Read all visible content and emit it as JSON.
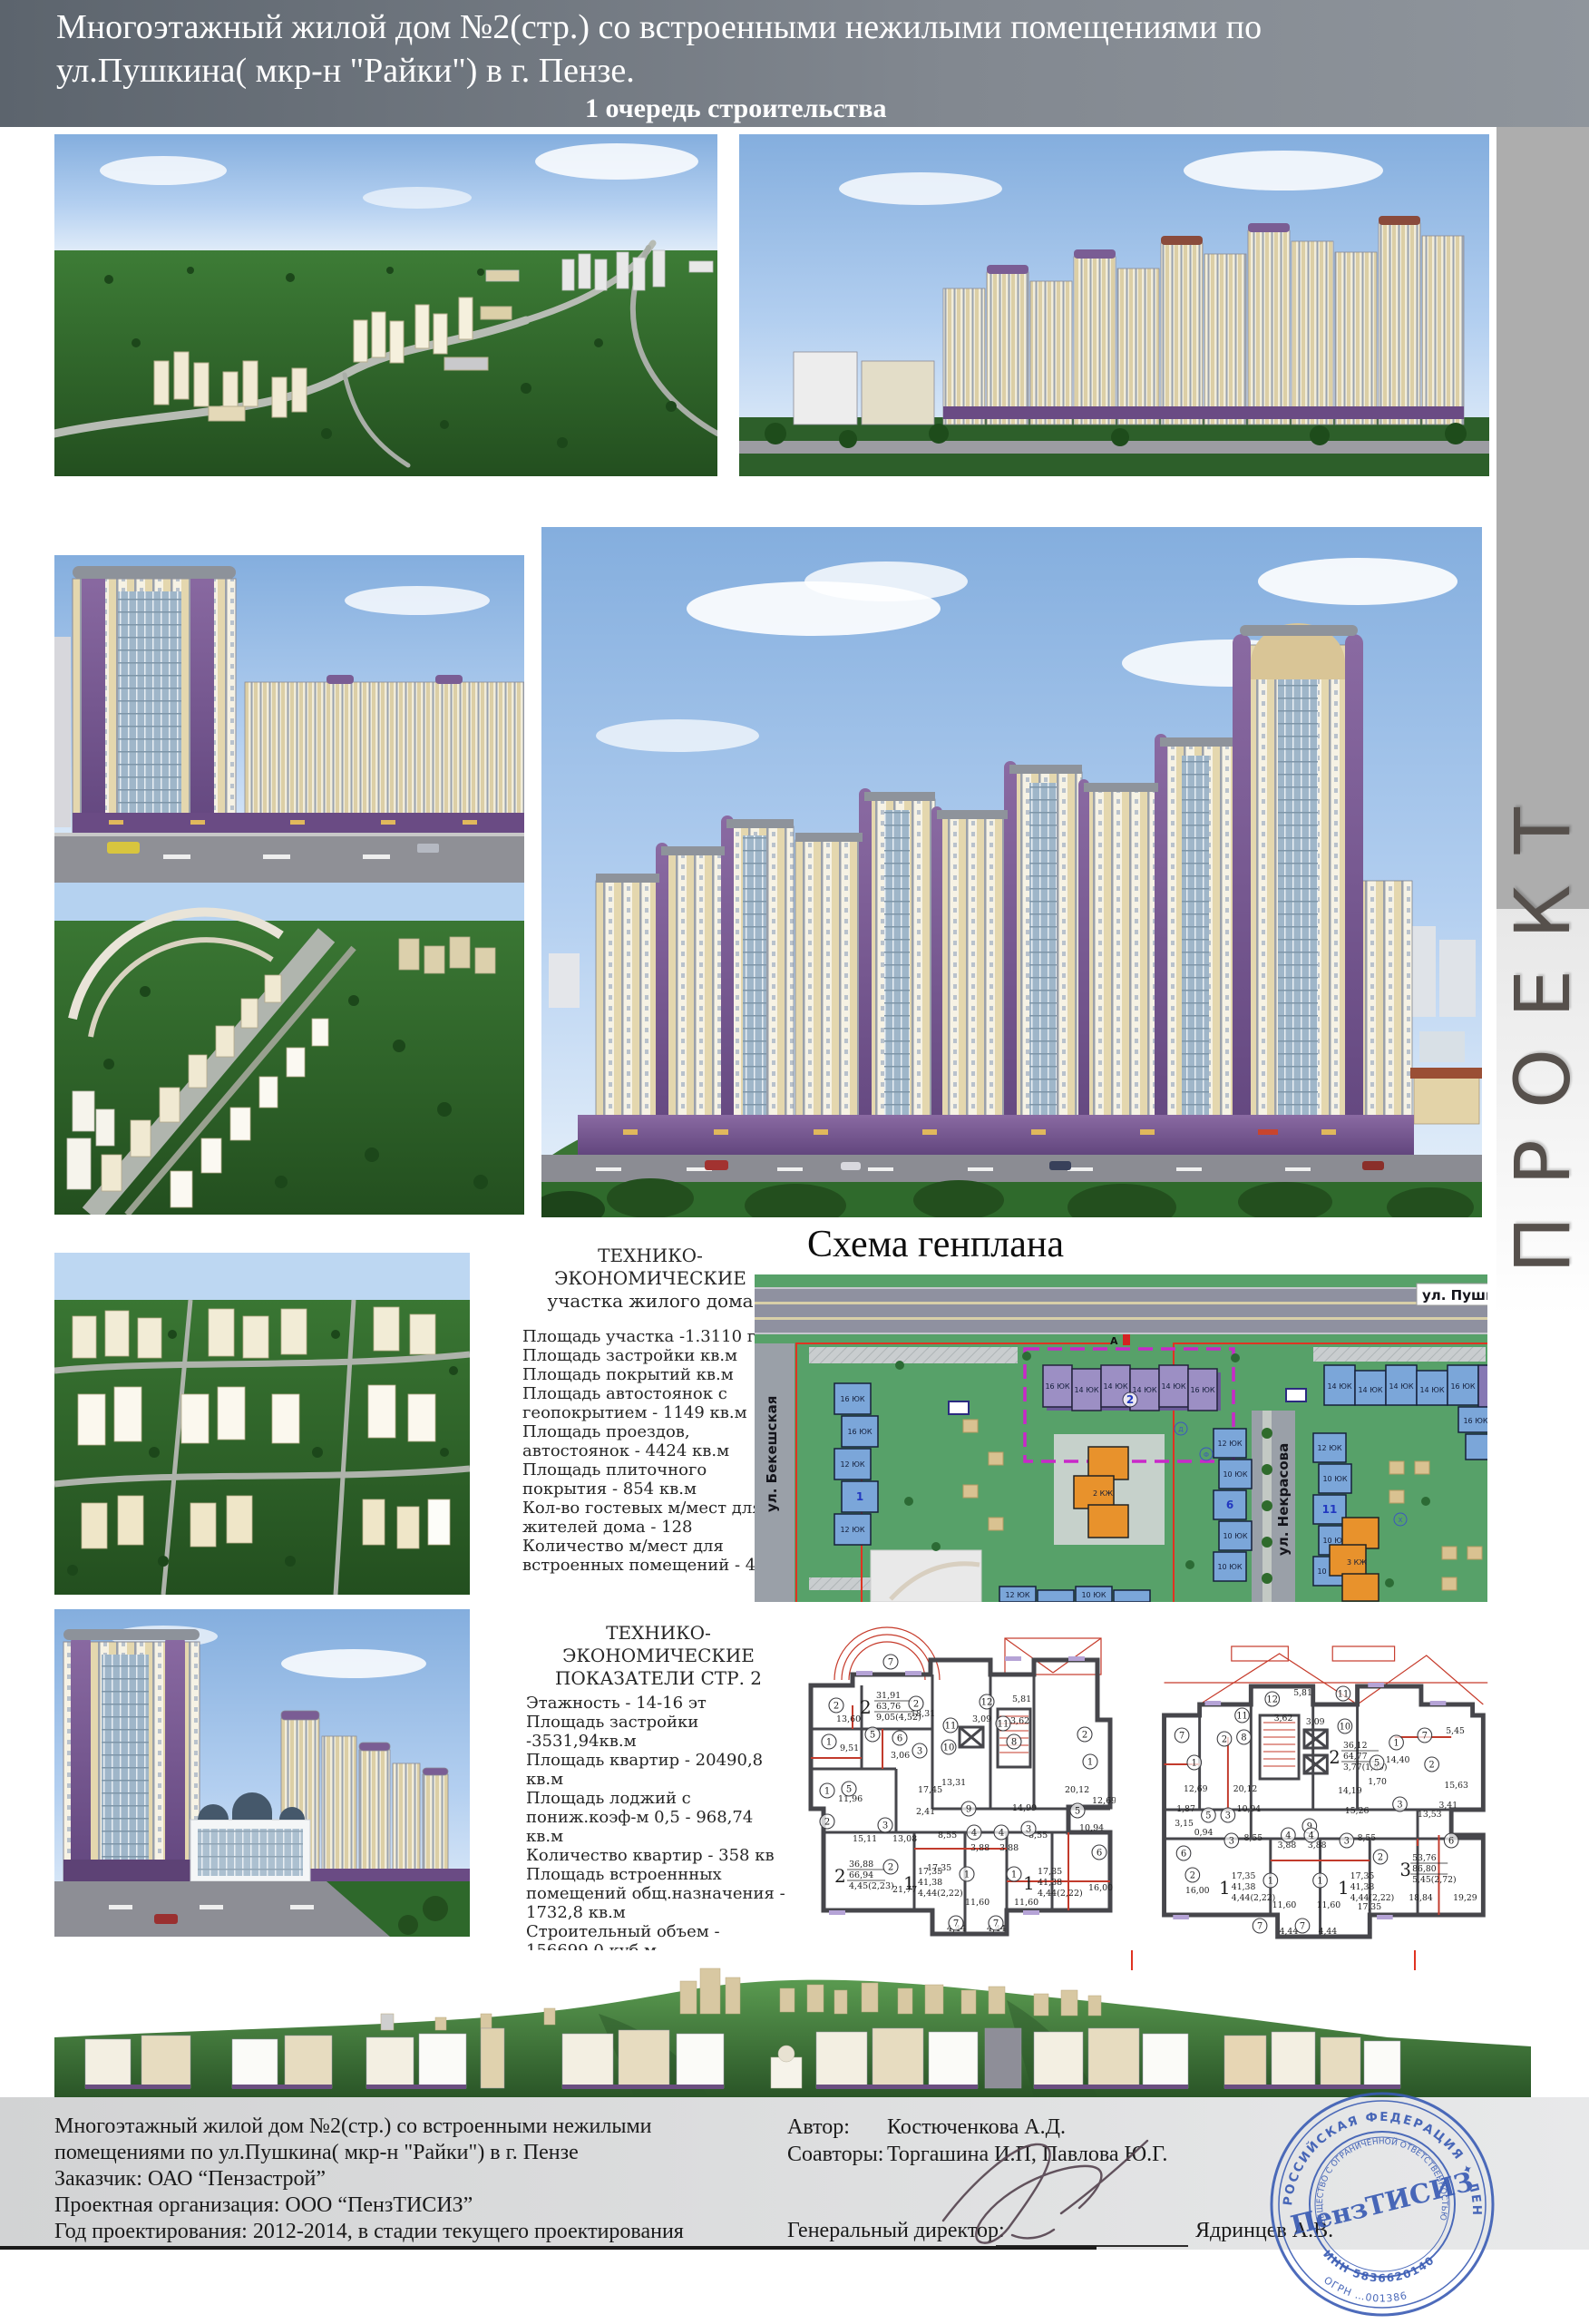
{
  "header": {
    "line1": "Многоэтажный жилой дом №2(стр.) со встроенными нежилыми помещениями по",
    "line2": "ул.Пушкина( мкр-н \"Райки\") в г. Пензе.",
    "line3": "1 очередь строительства"
  },
  "side_label": "ПРОЕКТ",
  "genplan": {
    "title": "Схема генплана",
    "street_pushkina": "ул. Пушкина",
    "street_bekeshskaya": "ул. Бекешская",
    "street_nekrasova": "ул. Некрасова",
    "marker_a": "А",
    "num_2": "2",
    "num_6": "6",
    "num_11": "11",
    "num_1": "1",
    "label_16": "16 ЮК",
    "label_14": "14 ЮК",
    "label_12": "12 ЮК",
    "label_10": "10 ЮК",
    "label_2kzh": "2 КЖ",
    "label_3kzh": "3 КЖ",
    "icon_d": "Д",
    "icon_f": "Ф",
    "icon_x": "Х"
  },
  "tep_site": {
    "title1": "ТЕХНИКО-ЭКОНОМИЧЕСКИЕ",
    "title2": "участка жилого дома",
    "lines": [
      "Площадь участка -1.3110 га",
      "Площадь застройки  кв.м",
      "Площадь  покрытий кв.м",
      "Площадь автостоянок с геопокрытием - 1149 кв.м",
      "Площадь проездов, автостоянок - 4424 кв.м",
      "Площадь плиточного покрытия - 854 кв.м",
      "Кол-во гостевых м/мест для жителей дома - 128",
      "Количество м/мест для встроенных помещений - 42"
    ]
  },
  "tep_bldg": {
    "title1": "ТЕХНИКО-ЭКОНОМИЧЕСКИЕ",
    "title2": "ПОКАЗАТЕЛИ СТР. 2",
    "lines": [
      "Этажность - 14-16 эт",
      "Площадь застройки -3531,94кв.м",
      "Площадь квартир - 20490,8 кв.м",
      "Площадь лоджий с пониж.коэф-м 0,5 - 968,74 кв.м",
      "Количество квартир - 358 кв",
      "Площадь встроеннных помещений общ.назначения - 1732,8 кв.м",
      "Строительный объем  - 156699,0 куб.м",
      "в т.ч. подземной части - 8707,3 куб.м"
    ]
  },
  "plans": {
    "g1": {
      "apt2a": [
        "2",
        "31,91",
        "63,76",
        "9,05(4,52)"
      ],
      "apt2b": [
        "2",
        "36,88",
        "66,94",
        "4,45(2,23)"
      ],
      "apt1": [
        "1",
        "17,35",
        "41,38",
        "4,44(2,22)"
      ],
      "areas": [
        "18,31",
        "13,60",
        "9,51",
        "3,06",
        "17,45",
        "11,96",
        "15,11",
        "13,08",
        "2,41",
        "8,55",
        "3,88",
        "3,88",
        "8,55",
        "17,35",
        "11,60",
        "11,60",
        "4,44",
        "4,44",
        "5,81",
        "3,62",
        "3,09",
        "13,31",
        "14,99",
        "20,12",
        "12,69",
        "10,94",
        "16,00",
        "21,77"
      ],
      "circles": [
        "7",
        "2",
        "2",
        "1",
        "5",
        "6",
        "3",
        "12",
        "11",
        "11",
        "8",
        "10",
        "9",
        "5",
        "1",
        "3",
        "2",
        "2",
        "4",
        "4",
        "1",
        "1",
        "7",
        "7",
        "2",
        "1",
        "5",
        "6",
        "3"
      ]
    },
    "g2": {
      "apt2": [
        "2",
        "36,12",
        "64,77",
        "3,77(1,89)"
      ],
      "apt3": [
        "3",
        "53,76",
        "86,80",
        "5,45(2,72)"
      ],
      "apt1": [
        "1",
        "17,35",
        "41,38",
        "4,44(2,22)"
      ],
      "areas": [
        "5,81",
        "3,62",
        "3,09",
        "14,40",
        "1,70",
        "5,45",
        "15,63",
        "3,41",
        "12,69",
        "20,12",
        "10,94",
        "1,87",
        "3,15",
        "0,94",
        "16,00",
        "8,55",
        "3,88",
        "3,88",
        "8,55",
        "11,60",
        "11,60",
        "17,35",
        "4,44",
        "4,44",
        "18,84",
        "19,29",
        "14,19",
        "15,26",
        "13,53"
      ],
      "circles": [
        "12",
        "11",
        "8",
        "11",
        "10",
        "9",
        "7",
        "2",
        "1",
        "1",
        "5",
        "3",
        "7",
        "2",
        "5",
        "3",
        "6",
        "2",
        "3",
        "3",
        "4",
        "4",
        "1",
        "1",
        "2",
        "6",
        "7",
        "7"
      ]
    }
  },
  "footer": {
    "left_lines": [
      "Многоэтажный жилой дом №2(стр.) со встроенными нежилыми",
      "помещениями по ул.Пушкина( мкр-н \"Райки\") в г. Пензе",
      "Заказчик: ОАО “Пензастрой”",
      "Проектная организация: ООО “ПензТИСИЗ”",
      "Год проектирования: 2012-2014, в стадии текущего проектирования"
    ],
    "author_label": "Автор:",
    "author": "Костюченкова А.Д.",
    "coauthors_label": "Соавторы:",
    "coauthors": "Торгашина И.П, Павлова Ю.Г.",
    "director_label": "Генеральный директор:",
    "director": "Ядринцев А.В."
  },
  "stamp": {
    "center": "ПензТИСИЗ",
    "ring_outer": "РОССИЙСКАЯ ФЕДЕРАЦИЯ ✦ ЛЕНИНСКИЙ РАЙОН",
    "ring_inner": "ОБЩЕСТВО С ОГРАНИЧЕННОЙ ОТВЕТСТВЕННОСТЬЮ",
    "inn": "ИНН 5836620140",
    "ogrn": "ОГРН …001386"
  },
  "colors": {
    "accent_purple": "#6a4b84",
    "facade_cream": "#e6dab2",
    "plan_green": "#57a169",
    "plan_blue": "#7ba6d9",
    "plan_orange": "#e8922c",
    "stamp_blue": "#3a5cb4",
    "boundary_red": "#e03322",
    "boundary_magenta": "#c928c9"
  }
}
